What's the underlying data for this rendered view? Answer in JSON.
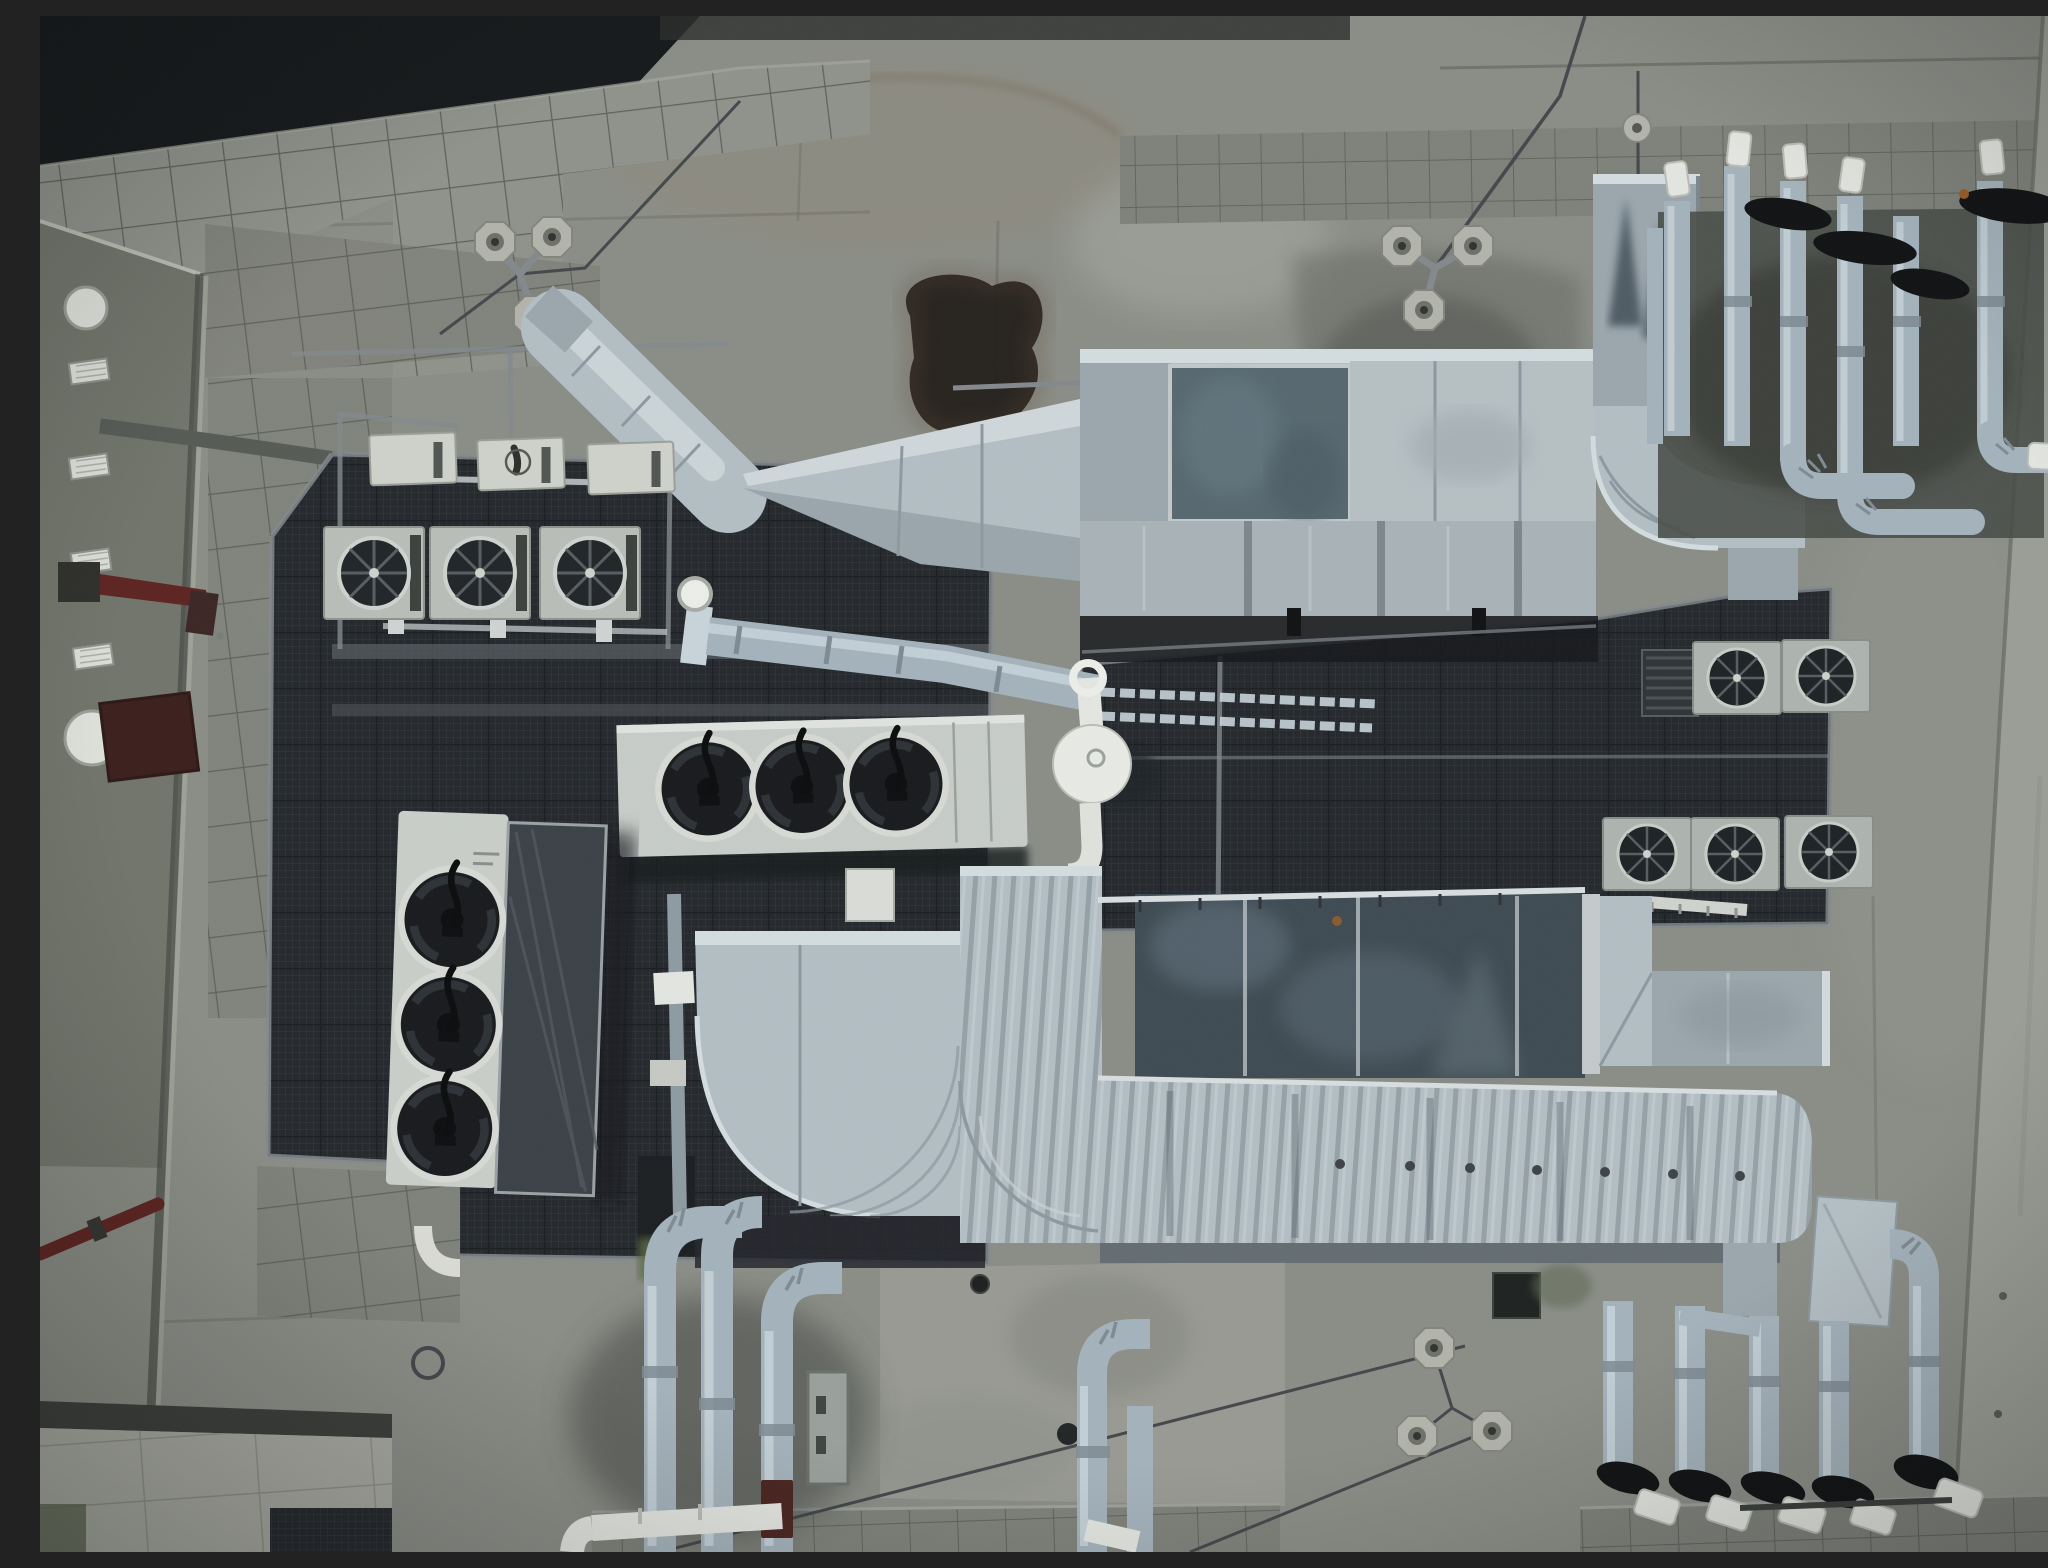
{
  "scene": {
    "title": "Aerial top-down view of a rooftop with HVAC equipment",
    "description": "Top-down drone photograph of a concrete building rooftop densely packed with HVAC machinery: air-handling units with galvanized ductwork, condenser units with large black axial fans, rows of small air-conditioner fan units on dark mesh service platforms, clusters of insulated risers with black and white caps, guy-wire anchor weights, paver tile walkways, an olive-grey side building wall with vents and a red standpipe, and weathered stained concrete throughout.",
    "view": "top-down aerial (nadir)",
    "lighting": "overcast, flat diffuse light, cool desaturated cast"
  },
  "palette": {
    "shadow_dark": "#15181a",
    "concrete": "#8a8d86",
    "concrete_light": "#9b9e96",
    "concrete_dark": "#73766f",
    "tile": "#7e817a",
    "tile_joint": "#5e6159",
    "tile_bright": "#a7a9a0",
    "wall_olive": "#70746a",
    "wall_right": "#9a9d95",
    "fixture_white": "#dfe1db",
    "red_pipe": "#5c2320",
    "red_hatch": "#3b1e1b",
    "mesh": "#23272b",
    "rail": "#82888c",
    "unit_body": "#b8bdb8",
    "unit_white": "#cacfca",
    "fan_dark": "#17191c",
    "fan_ring": "#d6d9d4",
    "duct": "#b3bec4",
    "duct_bright": "#d3dcdf",
    "duct_mid": "#9aa6ad",
    "duct_shadow": "#6e7a81",
    "panel_blue": "#56676f",
    "panel_dark": "#3e4a52",
    "pipe": "#a4b2bb",
    "pipe_bright": "#c8d4da",
    "pipe_cap_black": "#0f1113",
    "pipe_cap_white": "#e3e5e0",
    "weight": "#b2b4ab",
    "moss": "#5a6b45",
    "stain_black": "#1e1a15",
    "stain_brown": "#6b5443"
  },
  "counts": {
    "large_condenser_fans_horizontal_unit": 3,
    "large_condenser_fans_vertical_unit": 3,
    "small_ac_units_left_platform": 3,
    "ac_units_right_row_upper": 2,
    "ac_units_right_row_lower": 3,
    "white_service_lids": 3,
    "guy_wire_anchor_tripods": 3,
    "insulated_risers_top_right_cluster": 6,
    "insulated_risers_bottom_left_cluster": 3,
    "insulated_risers_bottom_right_cluster": 5
  },
  "objects": [
    {
      "name": "dark-roof-shadow-corner",
      "bbox": [
        0,
        0,
        660,
        190
      ]
    },
    {
      "name": "tiled-parapet-band-top-left",
      "bbox": [
        0,
        45,
        830,
        300
      ]
    },
    {
      "name": "tiled-band-top-right",
      "bbox": [
        1080,
        104,
        925,
        104
      ]
    },
    {
      "name": "left-building-wall",
      "bbox": [
        0,
        205,
        165,
        1331
      ]
    },
    {
      "name": "wall-dome-lights",
      "bbox": [
        24,
        272,
        56,
        476
      ]
    },
    {
      "name": "wall-vent-grilles",
      "bbox": [
        24,
        340,
        60,
        310
      ]
    },
    {
      "name": "red-standpipe-arm",
      "bbox": [
        18,
        548,
        160,
        70
      ]
    },
    {
      "name": "red-access-hatch",
      "bbox": [
        62,
        680,
        92,
        82
      ]
    },
    {
      "name": "mesh-platform-left",
      "bbox": [
        228,
        438,
        724,
        810
      ]
    },
    {
      "name": "mesh-platform-right",
      "bbox": [
        1042,
        572,
        750,
        343
      ]
    },
    {
      "name": "white-service-lids",
      "bbox": [
        328,
        415,
        310,
        58
      ]
    },
    {
      "name": "small-ac-units-row",
      "bbox": [
        288,
        513,
        305,
        90
      ]
    },
    {
      "name": "air-handler-duct-run",
      "bbox": [
        520,
        295,
        1036,
        305
      ]
    },
    {
      "name": "ahu-blue-panel",
      "bbox": [
        1130,
        350,
        180,
        155
      ]
    },
    {
      "name": "vertical-duct-with-stain",
      "bbox": [
        1553,
        158,
        107,
        262
      ]
    },
    {
      "name": "duct-elbow-curve-right",
      "bbox": [
        1553,
        390,
        212,
        170
      ]
    },
    {
      "name": "pipe-cluster-top-right",
      "bbox": [
        1615,
        130,
        425,
        390
      ]
    },
    {
      "name": "guy-anchor-tripod-left",
      "bbox": [
        430,
        200,
        100,
        115
      ]
    },
    {
      "name": "guy-anchor-tripod-right",
      "bbox": [
        1340,
        205,
        110,
        105
      ]
    },
    {
      "name": "guy-anchor-tripod-bottom",
      "bbox": [
        1360,
        1310,
        110,
        120
      ]
    },
    {
      "name": "condenser-horizontal-3fan",
      "bbox": [
        578,
        704,
        408,
        132
      ]
    },
    {
      "name": "condenser-vertical-3fan",
      "bbox": [
        352,
        798,
        210,
        378
      ]
    },
    {
      "name": "round-cowl-vent",
      "bbox": [
        1012,
        648,
        82,
        214
      ]
    },
    {
      "name": "ac-units-right-arrays",
      "bbox": [
        1560,
        620,
        275,
        255
      ]
    },
    {
      "name": "dark-mottled-ahu-box",
      "bbox": [
        1095,
        876,
        465,
        186
      ]
    },
    {
      "name": "curved-duct-elbow-bottom",
      "bbox": [
        655,
        915,
        265,
        290
      ]
    },
    {
      "name": "long-ribbed-duct-bottom",
      "bbox": [
        1058,
        1062,
        714,
        170
      ]
    },
    {
      "name": "pipe-cluster-bottom-left",
      "bbox": [
        548,
        1190,
        270,
        346
      ]
    },
    {
      "name": "pipe-cluster-bottom-right",
      "bbox": [
        1560,
        1230,
        400,
        280
      ]
    },
    {
      "name": "bright-paver-walkway-bottom-left",
      "bbox": [
        0,
        1395,
        352,
        141
      ]
    },
    {
      "name": "tile-walkways-bottom",
      "bbox": [
        552,
        1480,
        1496,
        56
      ]
    },
    {
      "name": "right-concrete-wall-band",
      "bbox": [
        1913,
        0,
        135,
        1536
      ]
    },
    {
      "name": "black-tar-stain",
      "bbox": [
        845,
        250,
        175,
        185
      ]
    },
    {
      "name": "wet-stain-region",
      "bbox": [
        1250,
        235,
        300,
        240
      ]
    }
  ]
}
